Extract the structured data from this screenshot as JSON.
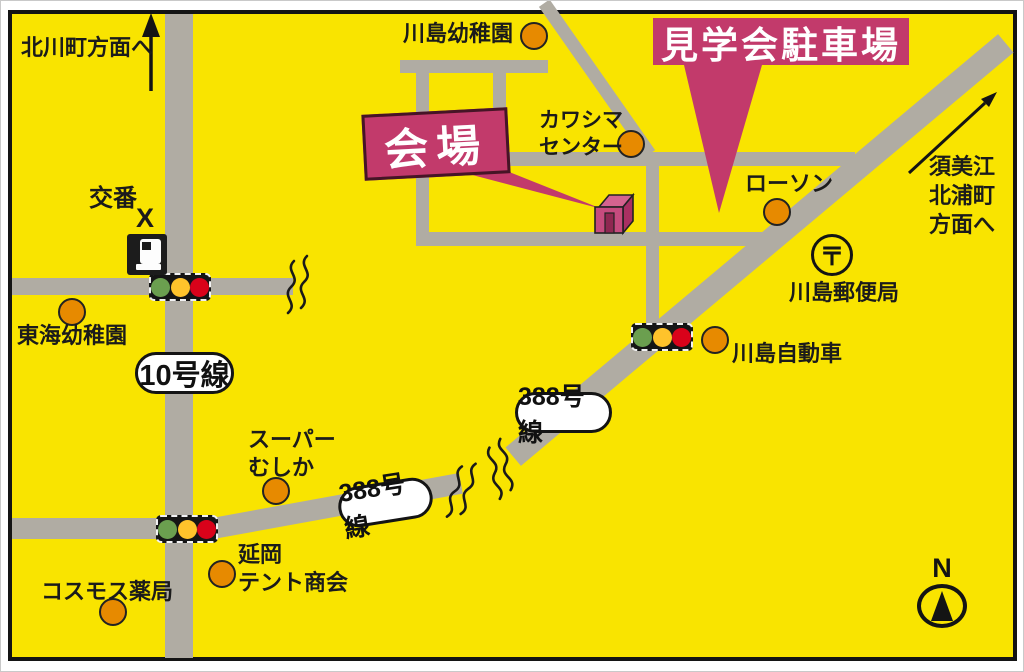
{
  "colors": {
    "map_background": "#F9E400",
    "road": "#B0ACA3",
    "accent_pink": "#C23A6B",
    "marker_orange": "#E78A00",
    "signal_green": "#6B9F4F",
    "signal_yellow": "#FFC32B",
    "signal_red": "#D9021A"
  },
  "parking": {
    "label": "見学会駐車場"
  },
  "venue": {
    "label": "会場"
  },
  "directions": {
    "north": "北川町方面へ",
    "northeast": "須美江\n北浦町\n方面へ"
  },
  "route_signs": {
    "route10": "10号線",
    "route388_upper": "388号線",
    "route388_lower": "388号線"
  },
  "police_box": {
    "label": "交番",
    "mark": "X"
  },
  "post_office": {
    "label": "川島郵便局",
    "symbol": "〒"
  },
  "pois": {
    "kawashima_kindergarten": "川島幼稚園",
    "kawashima_center": "カワシマ\nセンター",
    "lawson": "ローソン",
    "kawashima_motors": "川島自動車",
    "tokai_kindergarten": "東海幼稚園",
    "super_mushika": "スーパー\nむしか",
    "nobeoka_tent": "延岡\nテント商会",
    "cosmos_pharmacy": "コスモス薬局"
  },
  "compass": {
    "label": "N"
  }
}
